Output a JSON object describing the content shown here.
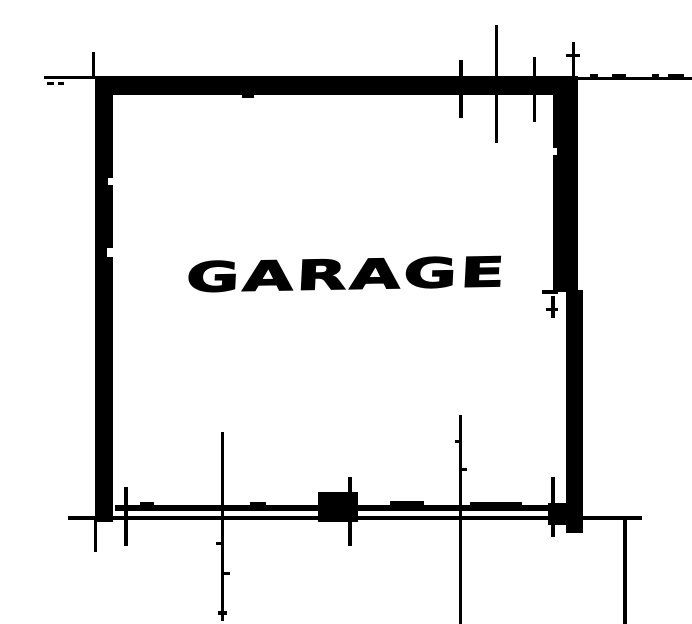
{
  "plan": {
    "room_label": "GARAGE",
    "ink_color": "#000000",
    "paper_color": "#ffffff"
  }
}
